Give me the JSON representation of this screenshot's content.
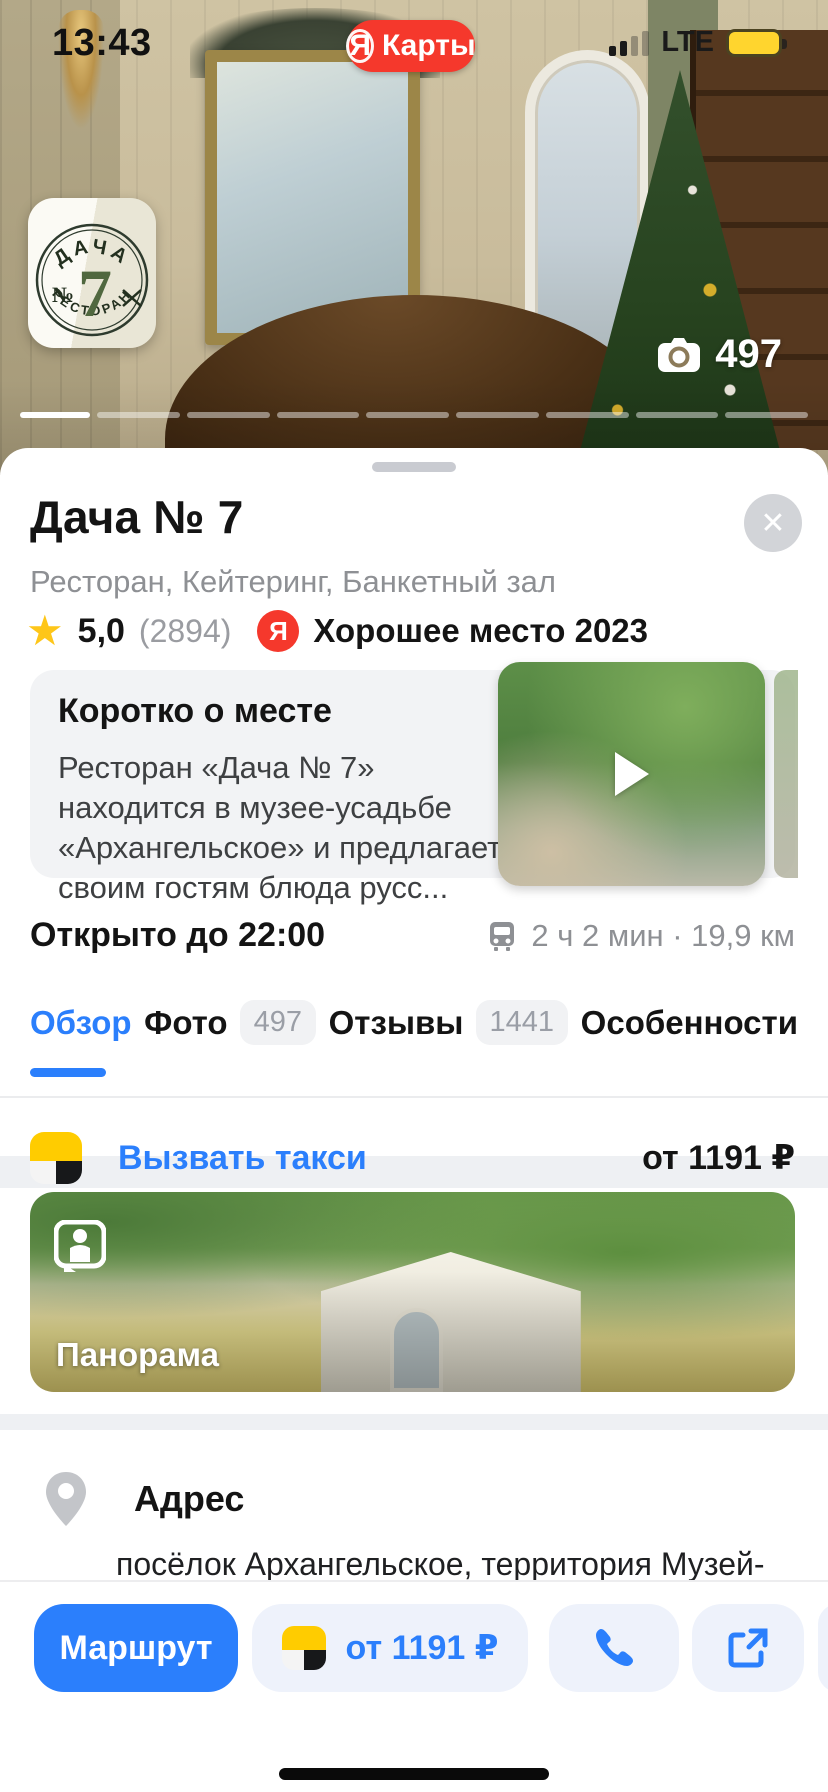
{
  "status_bar": {
    "time": "13:43",
    "network": "LTE",
    "app_badge_letter": "Я",
    "app_badge_label": "Карты"
  },
  "photo_header": {
    "photo_count": "497",
    "logo": {
      "arc_top": "ДАЧА",
      "number_sign": "№",
      "digit": "7",
      "arc_bottom": "РЕСТОРАН"
    }
  },
  "card": {
    "title": "Дача № 7",
    "close_label": "✕",
    "categories": "Ресторан, Кейтеринг, Банкетный зал",
    "rating": {
      "value": "5,0",
      "reviews": "(2894)",
      "award_letter": "Я",
      "award_text": "Хорошее место 2023"
    },
    "about": {
      "heading": "Коротко о месте",
      "text": "Ресторан «Дача № 7» находится в музее-усадьбе «Архангельское» и предлагает своим гостям блюда русс..."
    },
    "hours": "Открыто до 22:00",
    "route_info": "2 ч 2 мин · 19,9 км",
    "tabs": [
      {
        "label": "Обзор",
        "active": true
      },
      {
        "label": "Фото",
        "badge": "497"
      },
      {
        "label": "Отзывы",
        "badge": "1441"
      },
      {
        "label": "Особенности"
      }
    ],
    "taxi_row": {
      "label": "Вызвать такси",
      "price": "от 1191 ₽"
    },
    "panorama_label": "Панорама",
    "address": {
      "heading": "Адрес",
      "text": "посёлок Архангельское, территория Музей-"
    }
  },
  "action_bar": {
    "route_label": "Маршрут",
    "taxi_price": "от 1191 ₽"
  },
  "colors": {
    "accent_blue": "#2b7ffc",
    "brand_red": "#f5382c",
    "star_yellow": "#fec619",
    "battery_yellow": "#ffd52e"
  }
}
